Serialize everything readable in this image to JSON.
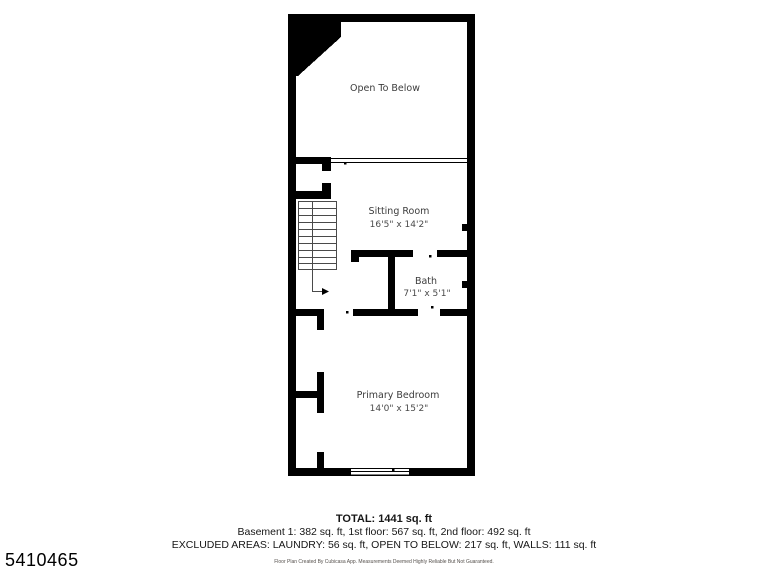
{
  "page": {
    "background": "#ffffff",
    "listing_id": "5410465"
  },
  "floor_plan": {
    "wall_color": "#000000",
    "label_color": "#3c3c3c",
    "rooms": {
      "open_to_below": {
        "name": "Open To Below"
      },
      "sitting_room": {
        "name": "Sitting Room",
        "dimensions": "16'5\" x 14'2\""
      },
      "bath": {
        "name": "Bath",
        "dimensions": "7'1\" x 5'1\""
      },
      "primary_bedroom": {
        "name": "Primary Bedroom",
        "dimensions": "14'0\" x 15'2\""
      }
    },
    "summary": {
      "total": "TOTAL: 1441 sq. ft",
      "floor_breakdown": "Basement 1: 382 sq. ft, 1st floor: 567 sq. ft, 2nd floor: 492 sq. ft",
      "excluded_areas": "EXCLUDED AREAS: LAUNDRY: 56 sq. ft, OPEN TO BELOW: 217 sq. ft, WALLS: 111 sq. ft",
      "disclaimer": "Floor Plan Created By Cubicasa App. Measurements Deemed Highly Reliable But Not Guaranteed."
    }
  }
}
